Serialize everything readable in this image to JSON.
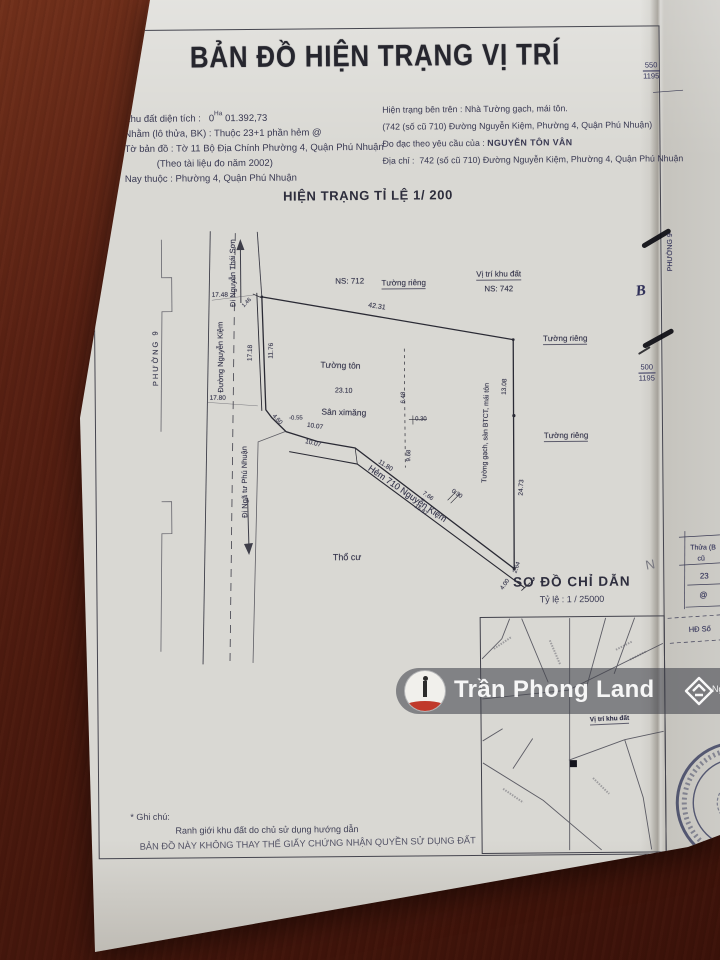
{
  "header": {
    "title": "BẢN ĐỒ HIỆN TRẠNG VỊ TRÍ"
  },
  "info_left": {
    "l1_label": "Khu đất diện tích :",
    "l1_zero": "0",
    "l1_unit": "Ha",
    "l1_value": "01.392,73",
    "l2": "Nhằm (lô thửa, BK) : Thuộc 23+1 phần hẻm @",
    "l3": "Tờ bản đồ : Tờ 11 Bộ Địa Chính Phường 4, Quận Phú Nhuận",
    "l4": "(Theo tài liệu đo năm 2002)",
    "l5": "Nay thuộc : Phường 4, Quận Phú Nhuận"
  },
  "info_right": {
    "l1": "Hiện trạng bên trên : Nhà Tường gạch, mái tôn.",
    "l2": "(742 (số cũ 710) Đường Nguyễn Kiệm, Phường 4, Quận Phú Nhuận)",
    "l3_label": "Đo đạc theo yêu cầu của :",
    "l3_name": "NGUYỄN TÔN VÂN",
    "l4_label": "Địa chỉ :",
    "l4_value": "742 (số cũ 710) Đường Nguyễn Kiệm, Phường 4, Quận Phú Nhuận"
  },
  "subtitle": {
    "text": "HIỆN TRẠNG TỈ LỆ 1/ 200"
  },
  "sodo": {
    "title": "SƠ ĐỒ CHỈ DẪN",
    "scale": "Tỷ lệ  :  1 / 25000"
  },
  "notes": {
    "star": "* Ghi chú:",
    "line1": "Ranh giới khu đất do chủ sử dụng hướng dẫn",
    "line2": "BẢN ĐỒ NÀY KHÔNG THAY THẾ GIẤY CHỨNG NHẬN QUYỀN SỬ DỤNG ĐẤT"
  },
  "watermark": {
    "text": "Trần Phong Land",
    "side": "Ngo"
  },
  "margin": {
    "frac_a": {
      "top": "550",
      "bottom": "1195"
    },
    "frac_b": {
      "top": "500",
      "bottom": "1195"
    },
    "labels": [
      {
        "n": "margin-phuong-9",
        "t": "PHƯỜNG 9",
        "x": 672,
        "y": 255,
        "r": -90,
        "s": 7,
        "c": "nv"
      },
      {
        "n": "margin-north-b",
        "t": "B",
        "x": 642,
        "y": 294,
        "r": -6,
        "s": 15,
        "c": "serif nv"
      },
      {
        "n": "margin-thua",
        "t": "Thửa (B",
        "x": 702,
        "y": 551,
        "r": 0,
        "s": 7,
        "c": "nv"
      },
      {
        "n": "margin-cu",
        "t": "cũ",
        "x": 700,
        "y": 562,
        "r": 0,
        "s": 7,
        "c": "nv"
      },
      {
        "n": "margin-23",
        "t": "23",
        "x": 703,
        "y": 579,
        "r": 0,
        "s": 8,
        "c": "nv"
      },
      {
        "n": "margin-at",
        "t": "@",
        "x": 702,
        "y": 598,
        "r": 0,
        "s": 8,
        "c": "nv"
      },
      {
        "n": "margin-hd-so",
        "t": "HĐ Số",
        "x": 698,
        "y": 632,
        "r": -2,
        "s": 7.5,
        "c": "nv"
      },
      {
        "n": "margin-n",
        "t": "N",
        "x": 649,
        "y": 567,
        "r": -10,
        "s": 13,
        "c": "gy"
      }
    ]
  },
  "plat": {
    "labels": [
      {
        "n": "label-ns-712",
        "t": "NS: 712",
        "x": 351,
        "y": 281,
        "r": 0,
        "s": 8
      },
      {
        "n": "label-tuong-rieng-top",
        "t": "Tường riêng",
        "x": 405,
        "y": 284,
        "r": 0,
        "s": 8,
        "c": "u"
      },
      {
        "n": "label-vi-tri-khu-dat",
        "t": "Vị trí khu đất",
        "x": 500,
        "y": 276,
        "r": 0,
        "s": 8,
        "c": "u"
      },
      {
        "n": "label-ns-742",
        "t": "NS: 742",
        "x": 500,
        "y": 290,
        "r": 0,
        "s": 8
      },
      {
        "n": "dim-42-31",
        "t": "42.31",
        "x": 378,
        "y": 307,
        "r": 9,
        "s": 7
      },
      {
        "n": "dim-17-48",
        "t": "17.48",
        "x": 221,
        "y": 294,
        "r": 0,
        "s": 6.5
      },
      {
        "n": "dim-17-80",
        "t": "17.80",
        "x": 218,
        "y": 397,
        "r": 0,
        "s": 6.5
      },
      {
        "n": "street-di-nguyen-thai-son",
        "t": "Đi Nguyễn Thái Sơn",
        "x": 234,
        "y": 272,
        "r": -90,
        "s": 7.5
      },
      {
        "n": "street-duong-nguyen-kiem",
        "t": "Đường Nguyễn Kiệm",
        "x": 221,
        "y": 356,
        "r": -90,
        "s": 7.5
      },
      {
        "n": "label-phuong-9-left",
        "t": "PHƯỜNG 9",
        "x": 156,
        "y": 356,
        "r": -90,
        "s": 7.5,
        "c": "sp"
      },
      {
        "n": "street-di-nga-tu-phu-nhuan",
        "t": "Đi Ngã tư Phú Nhuận",
        "x": 244,
        "y": 481,
        "r": -90,
        "s": 7.5
      },
      {
        "n": "dim-17-18",
        "t": "17.18",
        "x": 251,
        "y": 352,
        "r": -88,
        "s": 6.5
      },
      {
        "n": "dim-11-76",
        "t": "11.76",
        "x": 272,
        "y": 350,
        "r": -88,
        "s": 6.5
      },
      {
        "n": "dim-1-46",
        "t": "1.46",
        "x": 248,
        "y": 302,
        "r": -45,
        "s": 5.5
      },
      {
        "n": "label-tuong-ton",
        "t": "Tường tôn",
        "x": 341,
        "y": 365,
        "r": 2,
        "s": 8.5
      },
      {
        "n": "dim-23-10",
        "t": "23.10",
        "x": 344,
        "y": 391,
        "r": 2,
        "s": 7
      },
      {
        "n": "label-san-ximang",
        "t": "Sân ximăng",
        "x": 344,
        "y": 412,
        "r": 2,
        "s": 8.5
      },
      {
        "n": "dim-4-60",
        "t": "4.60",
        "x": 277,
        "y": 419,
        "r": 48,
        "s": 6
      },
      {
        "n": "dim-0-55",
        "t": "-0.55",
        "x": 296,
        "y": 418,
        "r": 0,
        "s": 6
      },
      {
        "n": "dim-10-07-a",
        "t": "10.07",
        "x": 315,
        "y": 426,
        "r": 9,
        "s": 6.5
      },
      {
        "n": "dim-10-07-b",
        "t": "10.07",
        "x": 313,
        "y": 443,
        "r": 14,
        "s": 6.5
      },
      {
        "n": "dim-11-80",
        "t": "11.80",
        "x": 385,
        "y": 466,
        "r": 33,
        "s": 6.5
      },
      {
        "n": "label-hem-710-nguyen-kiem",
        "t": "Hẻm 710 Nguyễn Kiệm",
        "x": 407,
        "y": 494,
        "r": 35,
        "s": 9
      },
      {
        "n": "dim-6-48",
        "t": "6.48",
        "x": 404,
        "y": 398,
        "r": -88,
        "s": 6
      },
      {
        "n": "dim-9-68",
        "t": "9.68",
        "x": 409,
        "y": 456,
        "r": -88,
        "s": 6
      },
      {
        "n": "dim-0-30-a",
        "t": "0.30",
        "x": 421,
        "y": 420,
        "r": 0,
        "s": 6
      },
      {
        "n": "dim-7-66",
        "t": "7.66",
        "x": 427,
        "y": 497,
        "r": 36,
        "s": 6
      },
      {
        "n": "dim-15-87",
        "t": "15.87",
        "x": 420,
        "y": 511,
        "r": 36,
        "s": 6
      },
      {
        "n": "dim-0-30-b",
        "t": "0.30",
        "x": 456,
        "y": 495,
        "r": 36,
        "s": 6
      },
      {
        "n": "label-tuong-gach-san-btct",
        "t": "Tường gạch, sàn BTCT, mái tôn",
        "x": 486,
        "y": 434,
        "r": -88,
        "s": 7
      },
      {
        "n": "dim-13-08",
        "t": "13.08",
        "x": 505,
        "y": 388,
        "r": -87,
        "s": 6.5
      },
      {
        "n": "dim-24-73",
        "t": "24.73",
        "x": 521,
        "y": 489,
        "r": -87,
        "s": 6.5
      },
      {
        "n": "dim-2-64",
        "t": "2.64",
        "x": 516,
        "y": 569,
        "r": -70,
        "s": 6
      },
      {
        "n": "dim-4-00",
        "t": "4.00",
        "x": 504,
        "y": 586,
        "r": -55,
        "s": 6
      },
      {
        "n": "label-tuong-rieng-r1",
        "t": "Tường riêng",
        "x": 566,
        "y": 341,
        "r": 0,
        "s": 8,
        "c": "u"
      },
      {
        "n": "label-tuong-rieng-r2",
        "t": "Tường riêng",
        "x": 566,
        "y": 438,
        "r": 0,
        "s": 8,
        "c": "u"
      },
      {
        "n": "label-tho-cu",
        "t": "Thổ cư",
        "x": 346,
        "y": 557,
        "r": 0,
        "s": 9
      },
      {
        "n": "label-vi-tri-khu-dat-inset",
        "t": "Vị trí khu đất",
        "x": 607,
        "y": 722,
        "r": -2,
        "s": 6.5,
        "c": "u b"
      }
    ]
  },
  "colors": {
    "paper": "#d9d8d3",
    "wood": "#5a2113",
    "ink": "#33334a",
    "watermark_bar": "rgba(66,68,76,0.58)",
    "logo_red": "#c0392b",
    "seal_navy": "#2c3155"
  }
}
